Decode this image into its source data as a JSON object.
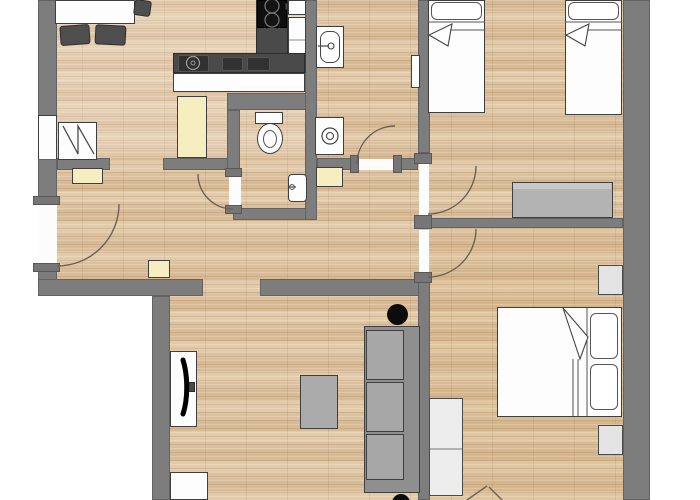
{
  "scene": "Apartment floor plan, top-down architectural view, no text visible in image",
  "palette": {
    "wall_gray": "#7d7d7d",
    "floor_wood": "#dcc19e",
    "outline": "#3f3f3f",
    "furniture_gray": "#a7a7a7",
    "furniture_dark": "#4a4a4a",
    "cream": "#f6eec0",
    "white": "#ffffff",
    "black": "#0e0e0e",
    "door_arc": "#6d6156"
  },
  "rooms": {
    "dining_kitchen": "Dining area and kitchen",
    "wc": "WC",
    "bathroom": "Bathroom",
    "hallway": "Hallway",
    "twin_bedroom": "Twin bedroom",
    "double_bedroom": "Double bedroom",
    "living_room": "Living room"
  },
  "furniture": {
    "dining_table": "Dining table",
    "chair": "Chair",
    "kitchen_counter": "Kitchen counter",
    "counter_sink": "Counter sink",
    "basin_tray": "Counter basin",
    "cooktop": "Cooktop with burners",
    "fridge": "Refrigerator",
    "wall_appliance": "Kitchen appliance",
    "pantry": "Pantry cabinet",
    "radiator": "Radiator",
    "window": "Window",
    "entrance_door": "Entrance door",
    "door": "Interior door",
    "toilet": "Toilet",
    "hand_basin": "Hand basin",
    "washbasin": "Washbasin",
    "washing_machine": "Washing machine",
    "shelf": "Shelf",
    "towel_radiator": "Towel radiator",
    "single_bed": "Single bed",
    "double_bed": "Double bed",
    "pillow": "Pillow",
    "sideboard": "Sideboard",
    "nightstand": "Nightstand",
    "wardrobe": "Wardrobe",
    "sofa": "Sofa",
    "coffee_table": "Coffee table",
    "tv_board": "TV board",
    "tv": "Television",
    "plant": "Plant / floor lamp",
    "cabinet": "Cabinet"
  }
}
